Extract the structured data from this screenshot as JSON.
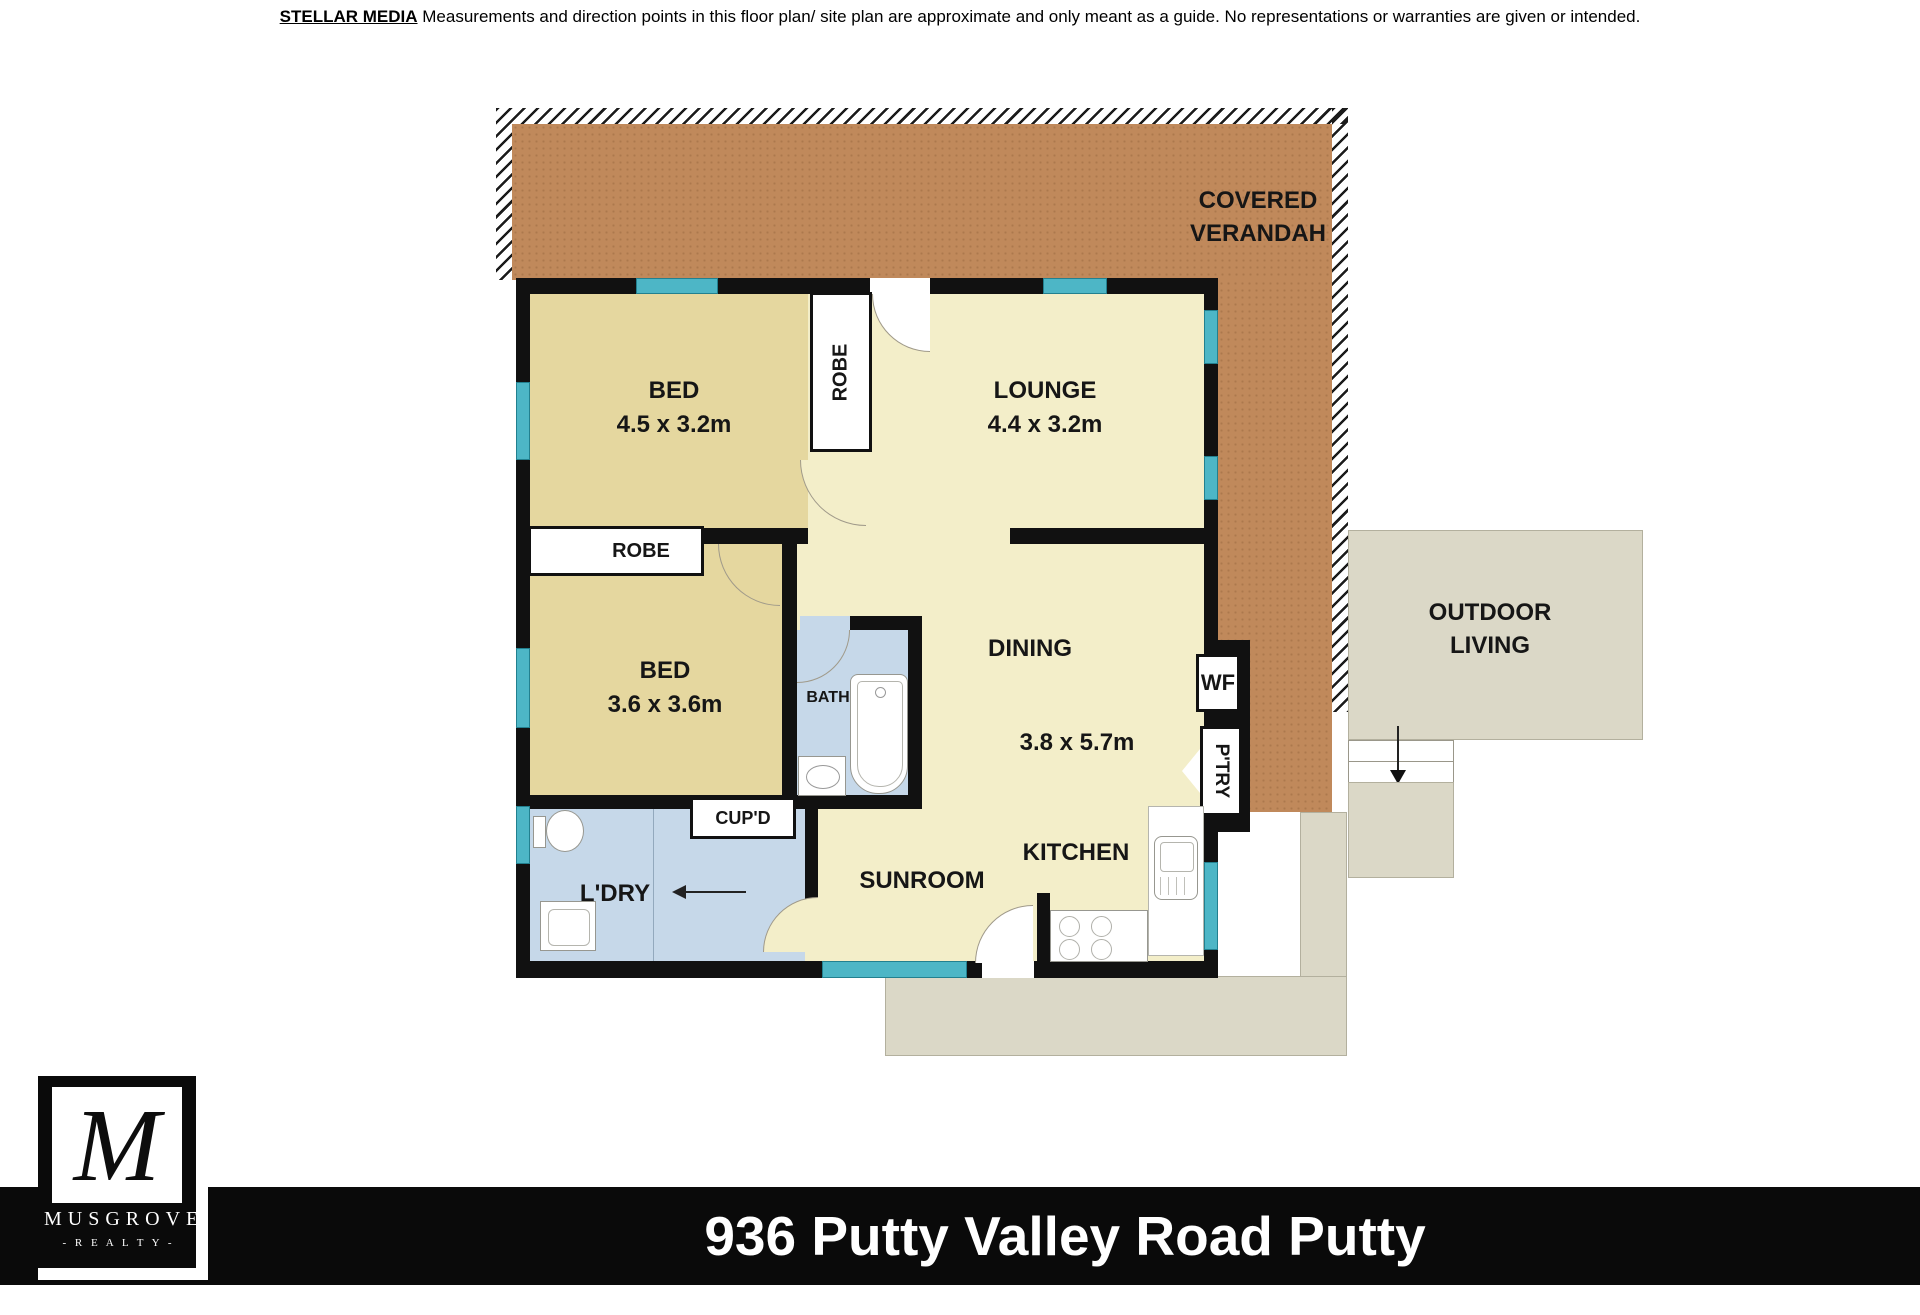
{
  "disclaimer": {
    "brand": "STELLAR MEDIA",
    "text": "Measurements and direction points in this floor plan/ site plan are approximate and only meant as a guide. No representations or warranties are given or intended."
  },
  "plan": {
    "verandah": {
      "line1": "COVERED",
      "line2": "VERANDAH"
    },
    "outdoor_living": {
      "line1": "OUTDOOR",
      "line2": "LIVING"
    },
    "rooms": {
      "bed1": {
        "name": "BED",
        "dims": "4.5 x 3.2m"
      },
      "lounge": {
        "name": "LOUNGE",
        "dims": "4.4 x 3.2m"
      },
      "bed2": {
        "name": "BED",
        "dims": "3.6 x 3.6m"
      },
      "dining": {
        "name": "DINING",
        "dims": "3.8 x 5.7m"
      },
      "kitchen": {
        "name": "KITCHEN"
      },
      "sunroom": {
        "name": "SUNROOM"
      },
      "bath": {
        "name": "BATH"
      },
      "laundry": {
        "name": "L'DRY"
      },
      "robe_bed1": {
        "name": "ROBE"
      },
      "robe_bed2": {
        "name": "ROBE"
      },
      "cupboard": {
        "name": "CUP'D"
      },
      "pantry": {
        "name": "P'TRY"
      },
      "wood_fire": {
        "name": "WF"
      }
    }
  },
  "footer": {
    "address": "936 Putty Valley Road Putty",
    "logo": {
      "monogram": "M",
      "name": "MUSGROVE",
      "tagline": "- R E A L T Y -"
    }
  },
  "colors": {
    "verandah_brown": "#C0895B",
    "floor_cream": "#F3EEC9",
    "floor_tan": "#E5D79F",
    "wet_area_blue": "#C6D8E9",
    "outdoor_grey": "#DBD8C7",
    "window_teal": "#4DB6C6",
    "wall_black": "#111111",
    "footer_black": "#0A0A0A"
  }
}
